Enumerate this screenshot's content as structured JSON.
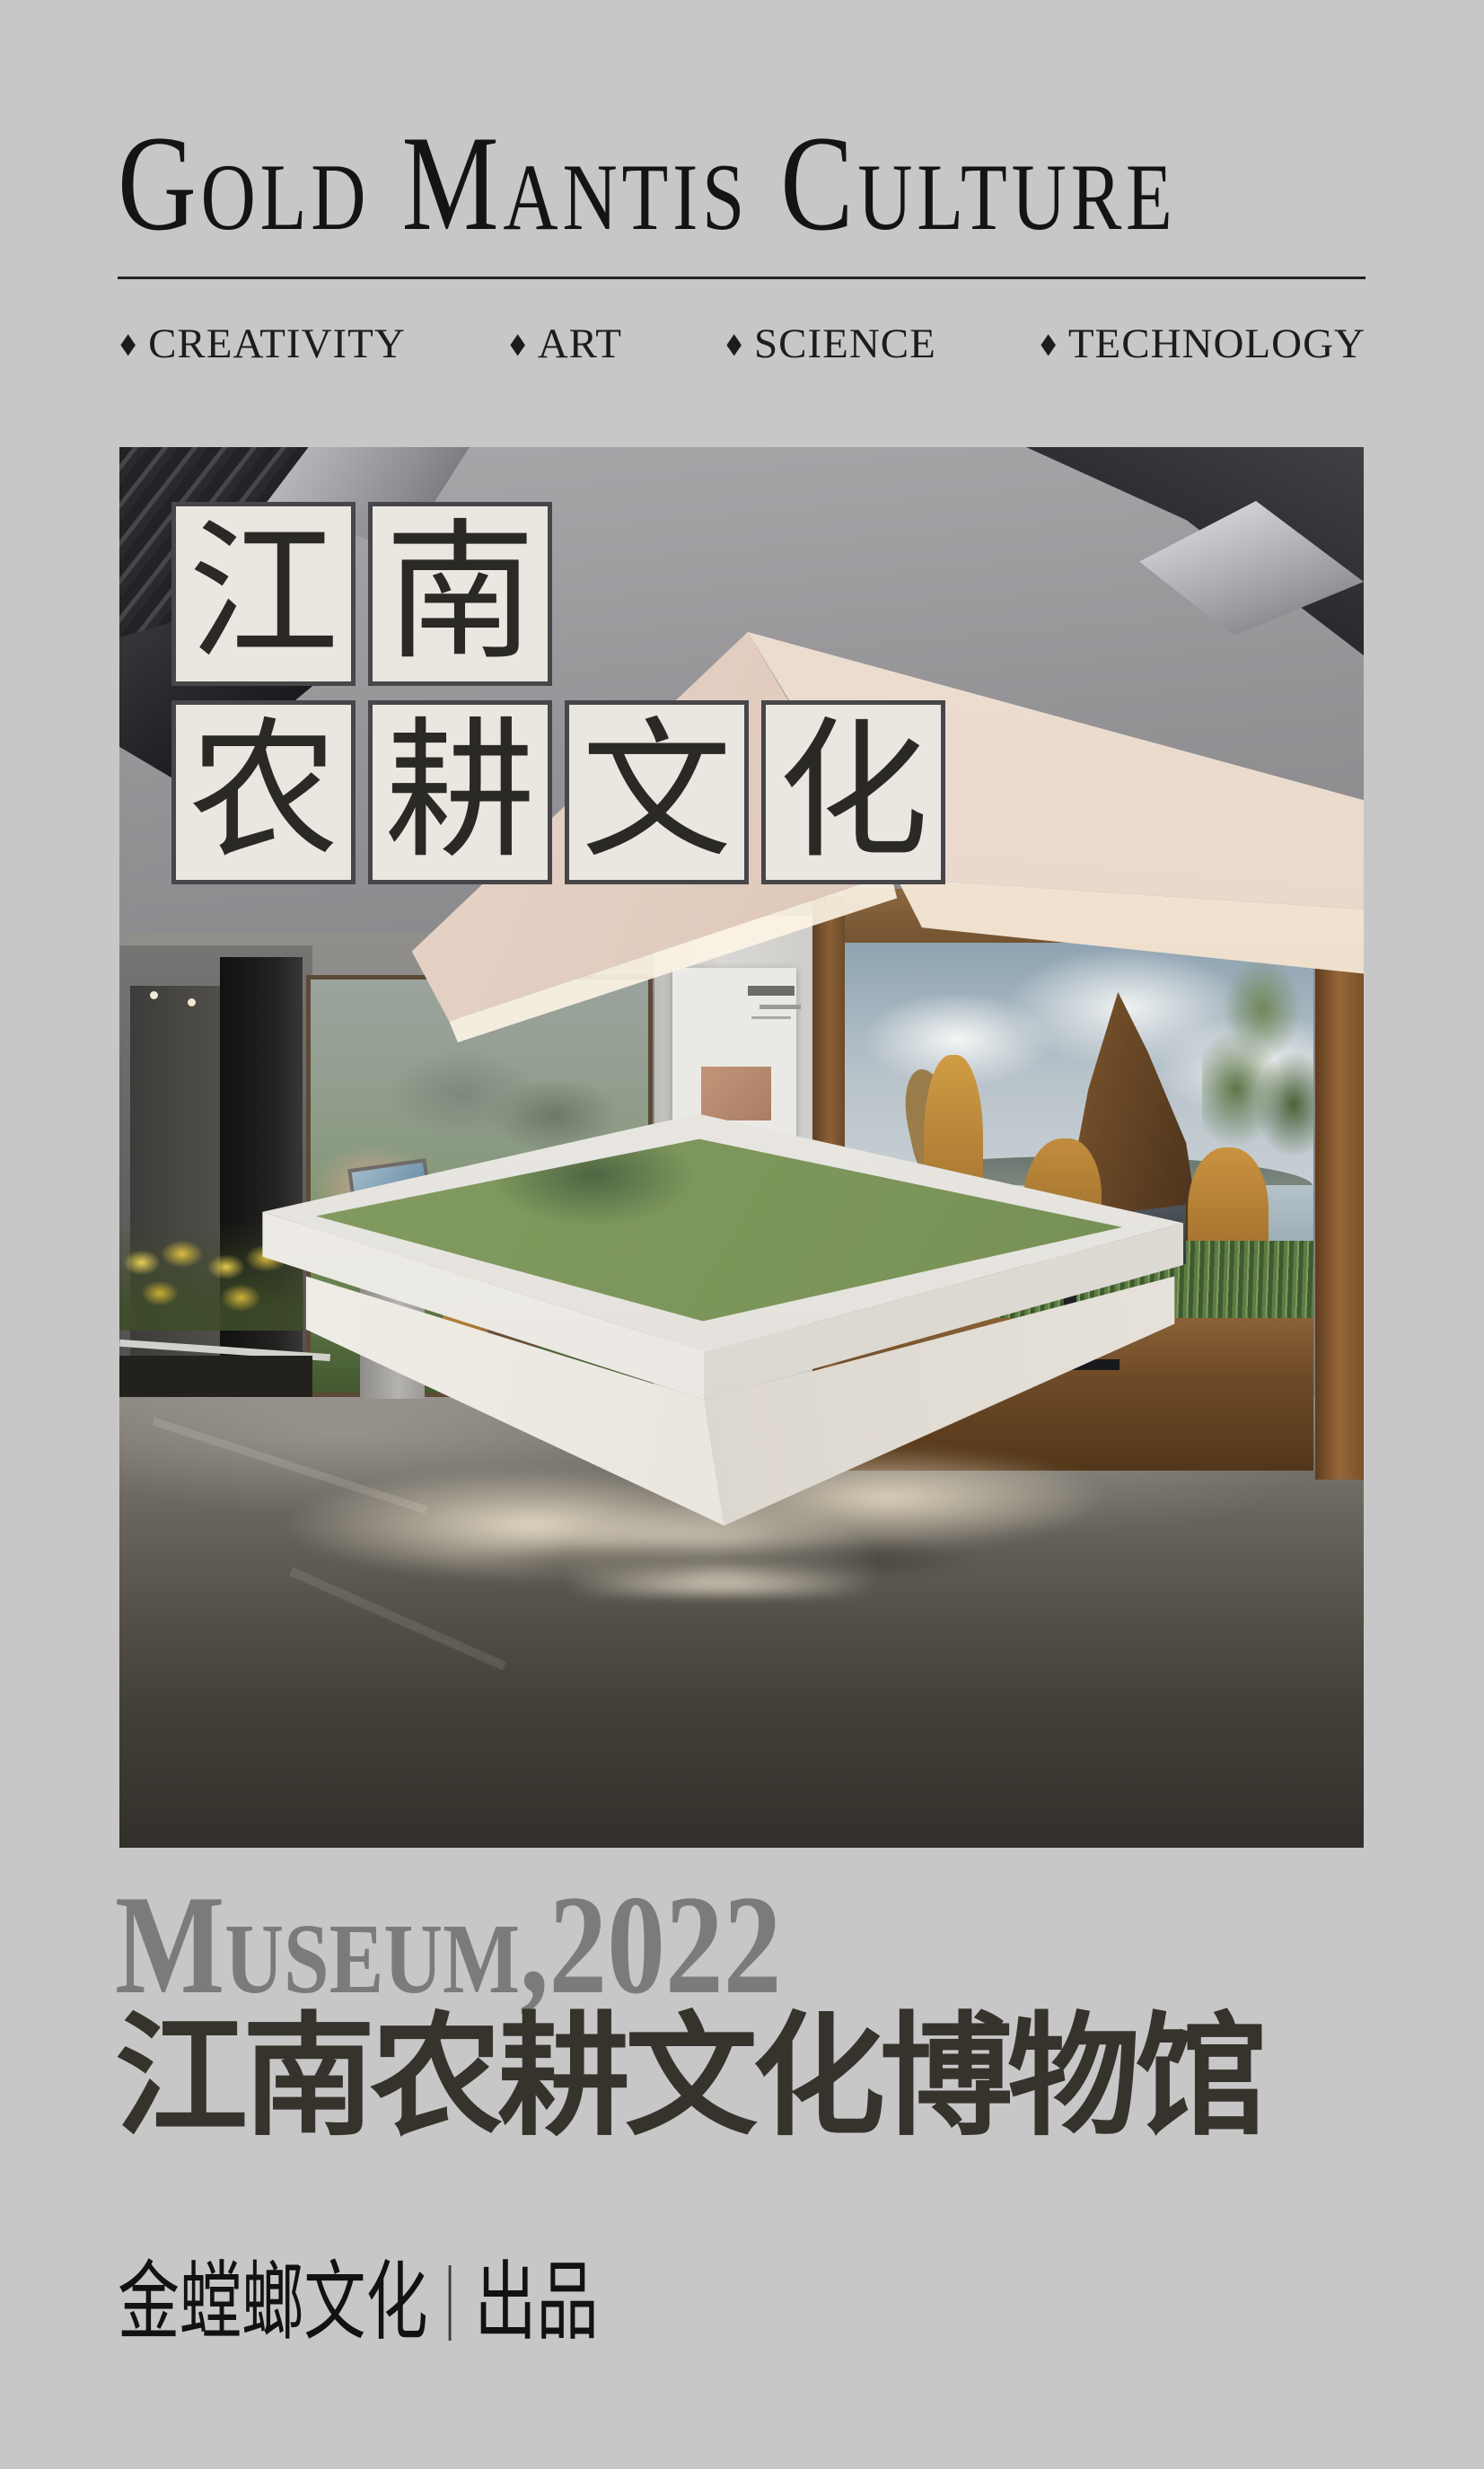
{
  "header": {
    "brand": "Gold Mantis Culture",
    "tag_bullet": "◆",
    "tags": [
      "CREATIVITY",
      "ART",
      "SCIENCE",
      "TECHNOLOGY"
    ]
  },
  "photo_overlay": {
    "chars_row1": [
      "江",
      "南"
    ],
    "chars_row2": [
      "农",
      "耕",
      "文",
      "化"
    ]
  },
  "footer": {
    "subtitle_en": "Museum,2022",
    "title_cn": "江南农耕文化博物馆",
    "producer_name": "金螳螂文化",
    "producer_suffix": "出品"
  },
  "colors": {
    "page_background": "#c7c7c7",
    "brand_text": "#141414",
    "tile_fill": "#eae7e0",
    "tile_border": "#47464a",
    "tile_char": "#2b2925",
    "subtitle_gray": "#7b7b7b",
    "title_cn_color": "#36322c",
    "soffit_cream": "#e6d6ca",
    "statue_gold": "#c0893f",
    "map_green": "#86a065",
    "floor_dark": "#393530",
    "flower_yellow": "#dabd3f"
  }
}
